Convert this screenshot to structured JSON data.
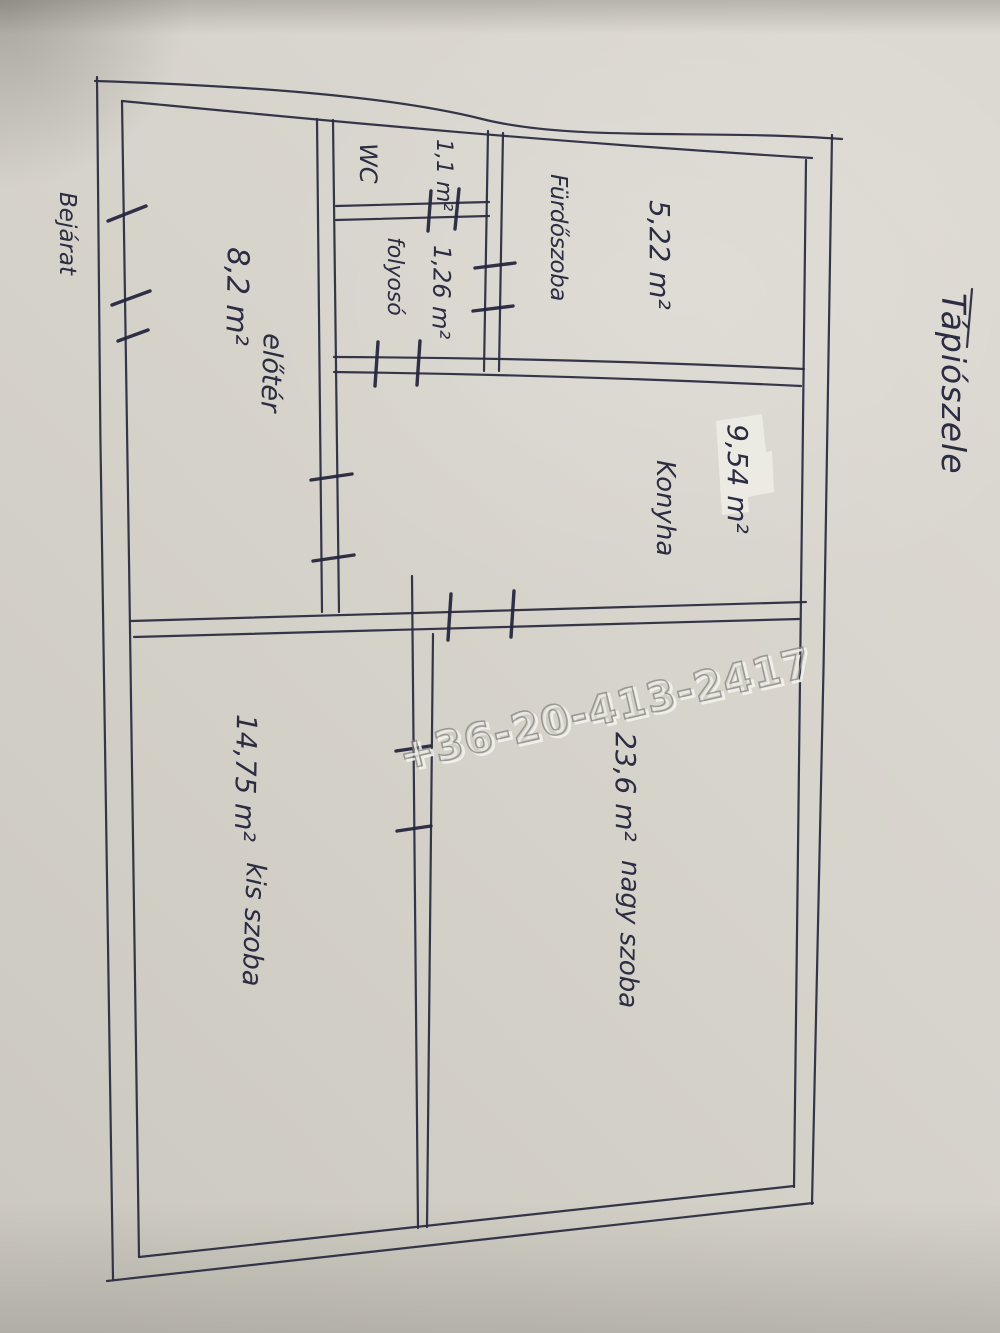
{
  "photo": {
    "title": "Tápiószele",
    "entrance_label": "Bejárat",
    "watermark_phone": "+36-20-413-2417"
  },
  "rooms": {
    "eloter": {
      "area": "8,2 m²",
      "name": "előtér"
    },
    "wc": {
      "name": "WC",
      "area": "1,1 m²"
    },
    "folyoso": {
      "name": "folyosó",
      "area": "1,26 m²"
    },
    "furdoszoba": {
      "name": "Fürdőszoba",
      "area": "5,22 m²"
    },
    "konyha": {
      "name": "Konyha",
      "area": "9,54 m²"
    },
    "kis_szoba": {
      "name": "kis szoba",
      "area": "14,75 m²"
    },
    "nagy_szoba": {
      "name": "nagy szoba",
      "area": "23,6 m²"
    }
  },
  "colors": {
    "paper": "#d6d3cb",
    "ink": "#2c2c42",
    "watermark": "#8b8a85",
    "patch": "#edece4"
  }
}
